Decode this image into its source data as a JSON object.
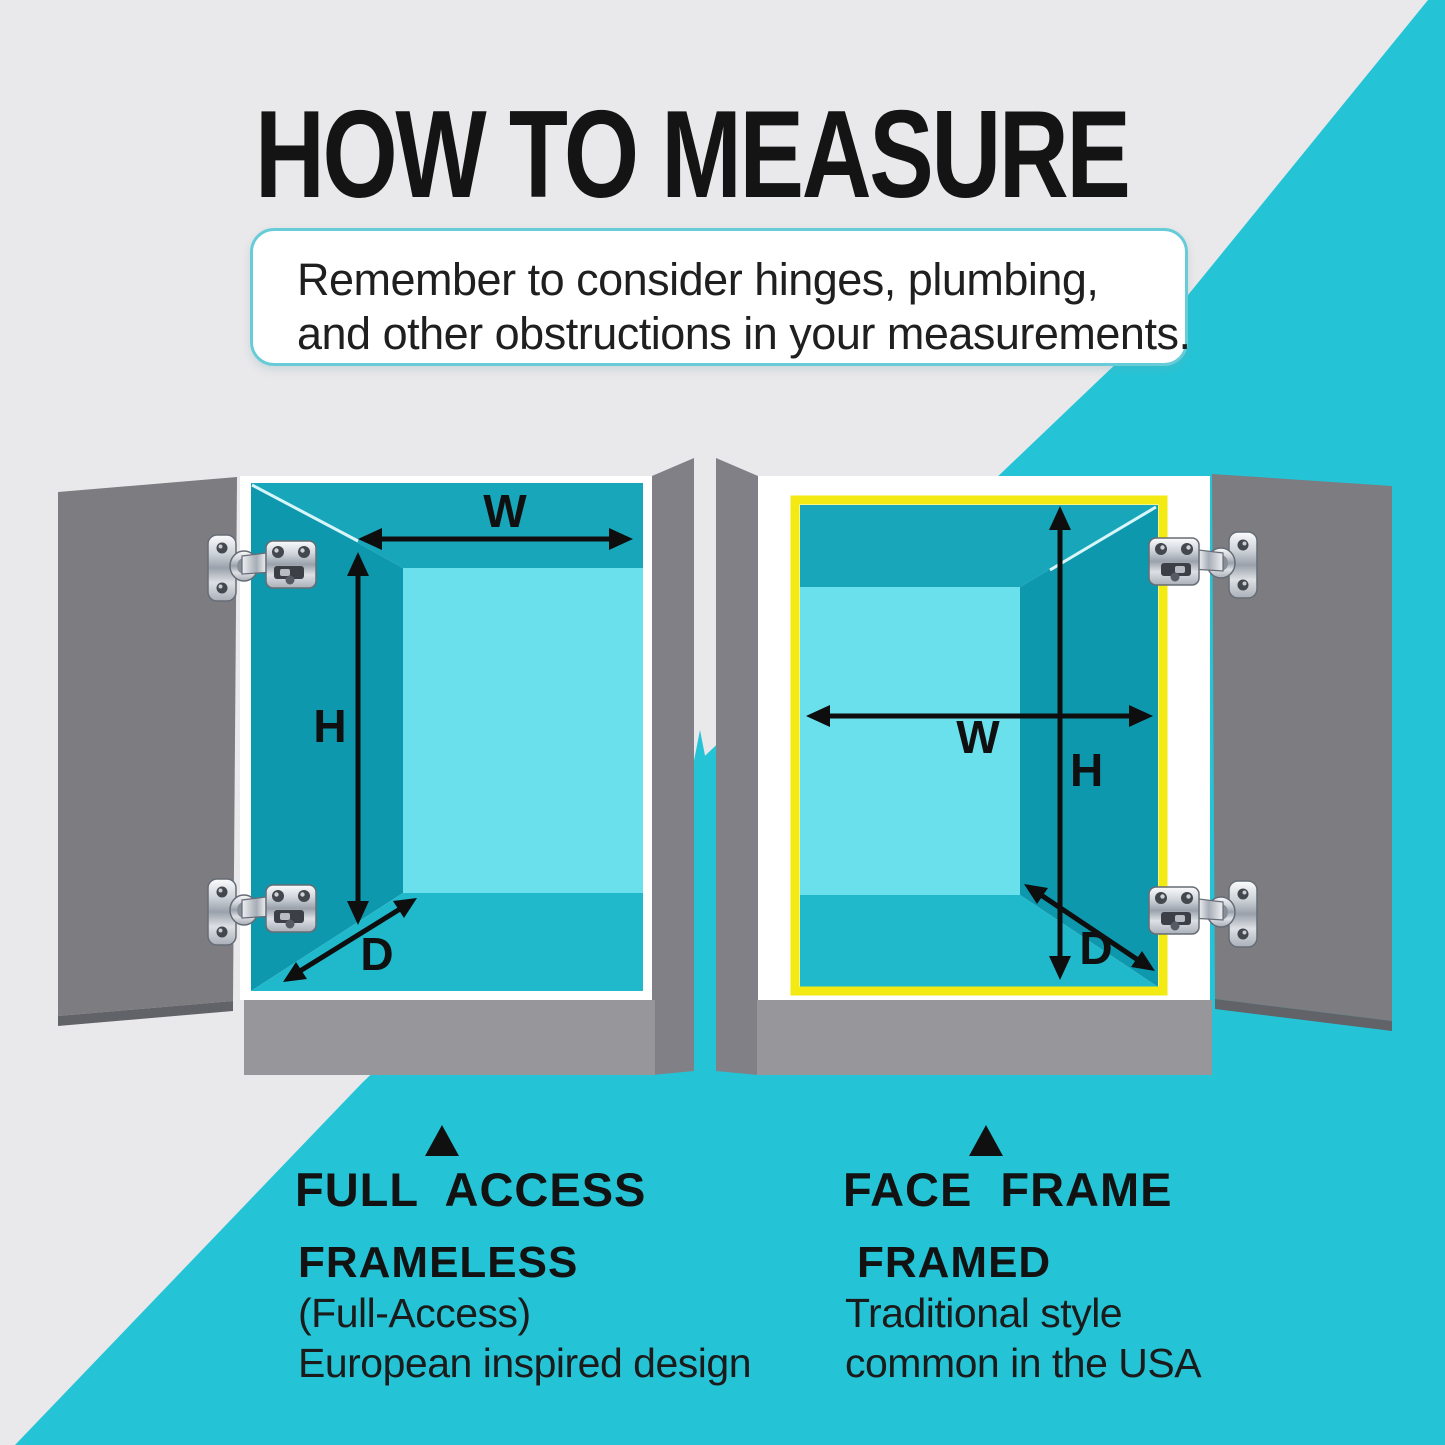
{
  "title": "HOW TO MEASURE",
  "note": {
    "line1": "Remember to consider hinges, plumbing,",
    "line2": "and other obstructions in your measurements."
  },
  "diagram": {
    "left_cabinet": {
      "type": "frameless cabinet, door open to the left, two concealed hinges",
      "width_label": "W",
      "height_label": "H",
      "depth_label": "D"
    },
    "right_cabinet": {
      "type": "face-frame cabinet with yellow frame outline, door open to the right, two concealed hinges",
      "width_label": "W",
      "height_label": "H",
      "depth_label": "D"
    }
  },
  "sections": {
    "left": {
      "marker_icon": "up-triangle",
      "heading": "FULL ACCESS",
      "subheading": "FRAMELESS",
      "detail1": "(Full-Access)",
      "detail2": "European inspired design"
    },
    "right": {
      "marker_icon": "up-triangle",
      "heading": "FACE FRAME",
      "subheading": "FRAMED",
      "detail1": "Traditional style",
      "detail2": "common in the USA"
    }
  },
  "colors": {
    "background": "#e9e8ea",
    "accent_teal": "#24c4d6",
    "interior_side": "#0e98ae",
    "interior_top": "#18a6ba",
    "interior_floor": "#1fb9cb",
    "interior_back": "#69e0ec",
    "door_gray": "#7c7c81",
    "side_panel_gray": "#818086",
    "base_gray": "#97969b",
    "face_frame_yellow": "#f2ea12",
    "text_black": "#141414"
  }
}
